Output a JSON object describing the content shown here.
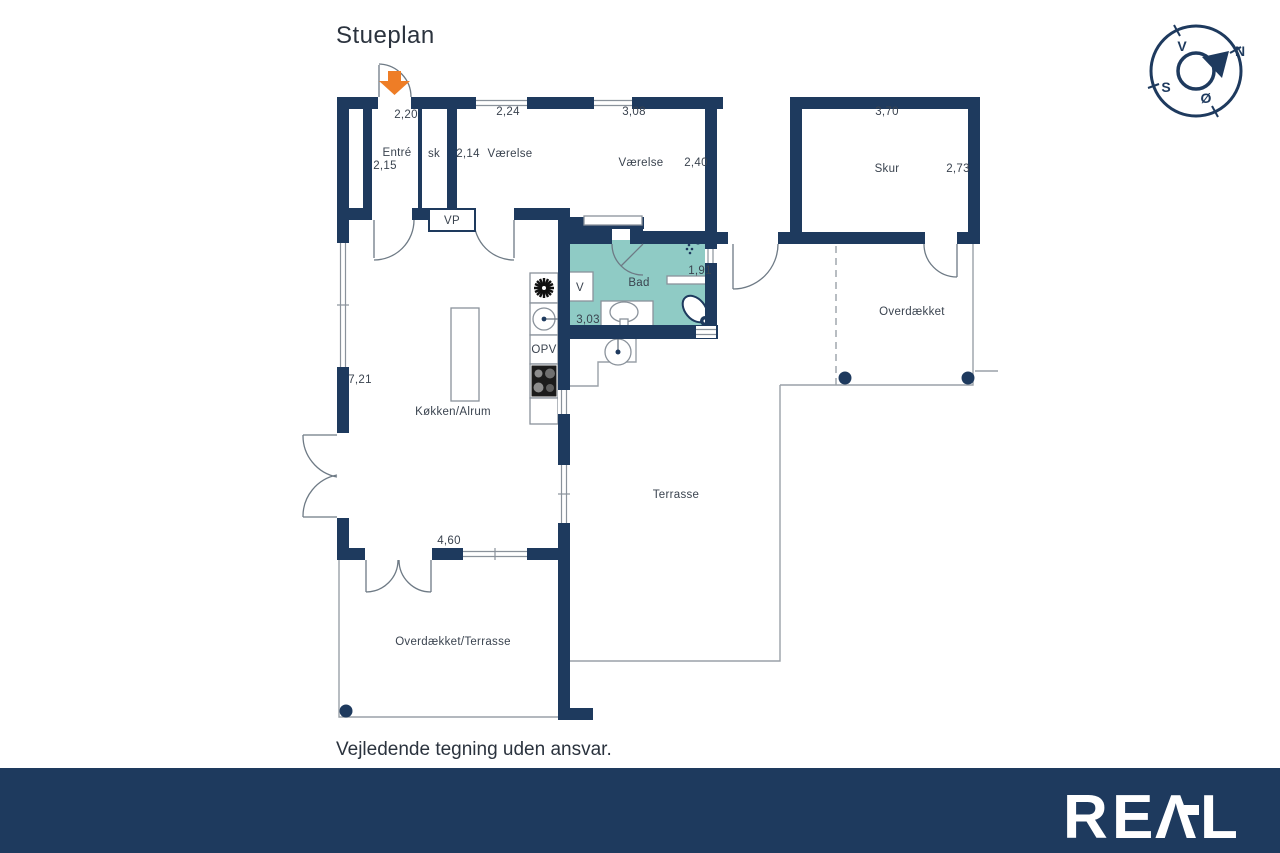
{
  "title": "Stueplan",
  "disclaimer": "Vejledende tegning uden ansvar.",
  "brand": {
    "name": "REAL",
    "letters": [
      "R",
      "E",
      "Λ",
      "L"
    ]
  },
  "compass": {
    "west": "V",
    "north": "N",
    "south": "S",
    "east": "Ø"
  },
  "colors": {
    "wall": "#1e3a5e",
    "bath": "#8fcbc5",
    "arrow": "#ee7d26",
    "footer": "#1e3a5e",
    "outline": "#9aa1a8"
  },
  "rooms": {
    "entre": {
      "name": "Entré",
      "dim_top": "2,20",
      "dim_side": "2,15"
    },
    "sk": {
      "name": "sk"
    },
    "vaerelse1": {
      "name": "Værelse",
      "dim_top": "2,24",
      "dim_side": "2,14"
    },
    "vaerelse2": {
      "name": "Værelse",
      "dim_top": "3,08",
      "dim_side": "2,40"
    },
    "skur": {
      "name": "Skur",
      "dim_top": "3,70",
      "dim_side": "2,73"
    },
    "bad": {
      "name": "Bad",
      "dim_side": "1,91",
      "dim_bottom": "3,03"
    },
    "koekken": {
      "name": "Køkken/Alrum",
      "dim_side": "7,21",
      "dim_bottom": "4,60"
    },
    "terrasse": {
      "name": "Terrasse"
    },
    "overdaekket": {
      "name": "Overdækket"
    },
    "overdaekket_terrasse": {
      "name": "Overdækket/Terrasse"
    }
  },
  "appliances": {
    "vp": "VP",
    "v": "V",
    "opv": "OPV"
  }
}
